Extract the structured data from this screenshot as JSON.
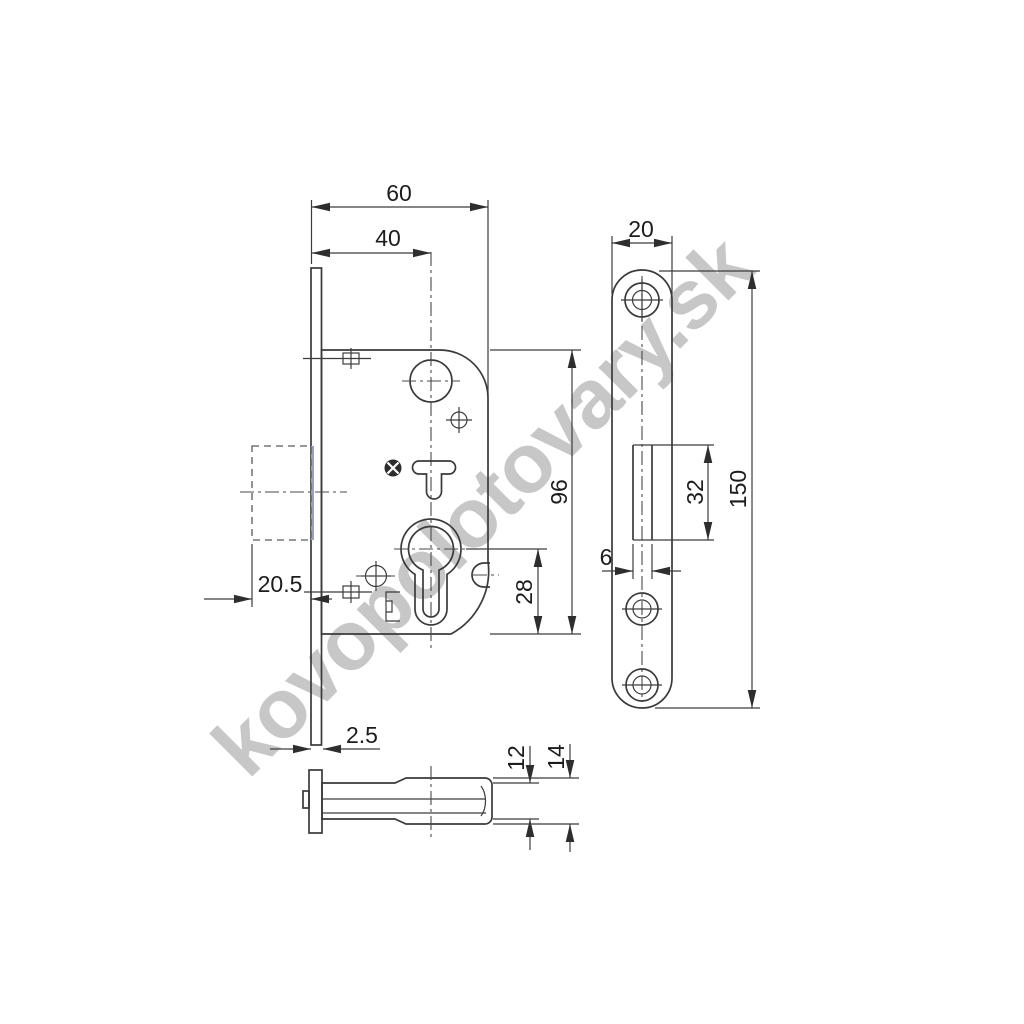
{
  "watermark": {
    "text": "kovopolotovary.sk",
    "color": "#c7c7c7"
  },
  "drawing": {
    "line_color": "#3a3a3a",
    "dims": {
      "case_depth": "60",
      "backset": "40",
      "case_height": "96",
      "cylinder_to_bottom": "28",
      "latch_protrusion": "20.5",
      "faceplate_thickness": "2.5",
      "plate_width": "20",
      "plate_cutout_height": "32",
      "plate_cutout_width": "6",
      "plate_height": "150",
      "body_inner_thickness": "12",
      "body_outer_thickness": "14"
    }
  }
}
